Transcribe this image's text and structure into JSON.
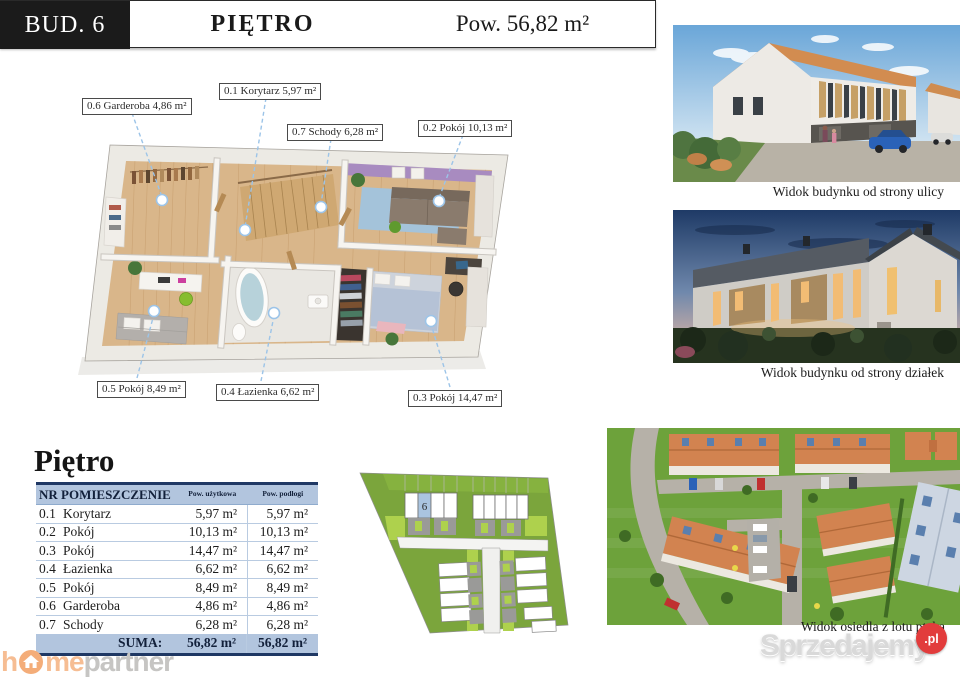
{
  "header": {
    "building": "BUD. 6",
    "floor_title": "PIĘTRO",
    "area": "Pow. 56,82 m²"
  },
  "plan_labels": [
    {
      "text": "0.1 Korytarz 5,97 m²"
    },
    {
      "text": "0.2 Pokój 10,13 m²"
    },
    {
      "text": "0.3 Pokój 14,47 m²"
    },
    {
      "text": "0.4 Łazienka 6,62 m²"
    },
    {
      "text": "0.5 Pokój 8,49 m²"
    },
    {
      "text": "0.6 Garderoba 4,86 m²"
    },
    {
      "text": "0.7 Schody 6,28 m²"
    }
  ],
  "photos": {
    "street_caption": "Widok budynku od strony ulicy",
    "plots_caption": "Widok budynku od strony działek",
    "aerial_caption": "Widok osiedla z lotu ptaka"
  },
  "site_plan": {
    "highlighted_unit": "6"
  },
  "table": {
    "title": "Piętro",
    "col_nr_name": "NR POMIESZCZENIE",
    "col_usable": "Pow. użytkowa",
    "col_floor": "Pow. podłogi",
    "rows": [
      {
        "nr": "0.1",
        "name": "Korytarz",
        "usable": "5,97 m²",
        "floor": "5,97 m²"
      },
      {
        "nr": "0.2",
        "name": "Pokój",
        "usable": "10,13 m²",
        "floor": "10,13 m²"
      },
      {
        "nr": "0.3",
        "name": "Pokój",
        "usable": "14,47 m²",
        "floor": "14,47 m²"
      },
      {
        "nr": "0.4",
        "name": "Łazienka",
        "usable": "6,62 m²",
        "floor": "6,62 m²"
      },
      {
        "nr": "0.5",
        "name": "Pokój",
        "usable": "8,49 m²",
        "floor": "8,49 m²"
      },
      {
        "nr": "0.6",
        "name": "Garderoba",
        "usable": "4,86 m²",
        "floor": "4,86 m²"
      },
      {
        "nr": "0.7",
        "name": "Schody",
        "usable": "6,28 m²",
        "floor": "6,28 m²"
      }
    ],
    "sum": {
      "label": "SUMA:",
      "usable": "56,82 m²",
      "floor": "56,82 m²"
    }
  },
  "footer": {
    "logo_h": "h",
    "logo_me": "me",
    "logo_partner": "partner"
  },
  "watermark": {
    "text": "Sprzedajemy",
    "badge": ".pl"
  },
  "colors": {
    "navy": "#1f3864",
    "table_blue": "#b2c5de",
    "site_green": "#7ba53c",
    "site_light_green": "#aed14d",
    "roof_orange": "#d28c50",
    "purple_wall": "#a88bc0",
    "logo_orange": "#f6bd93",
    "logo_gray": "#c6c5c3",
    "badge_red": "#e23c3c"
  }
}
